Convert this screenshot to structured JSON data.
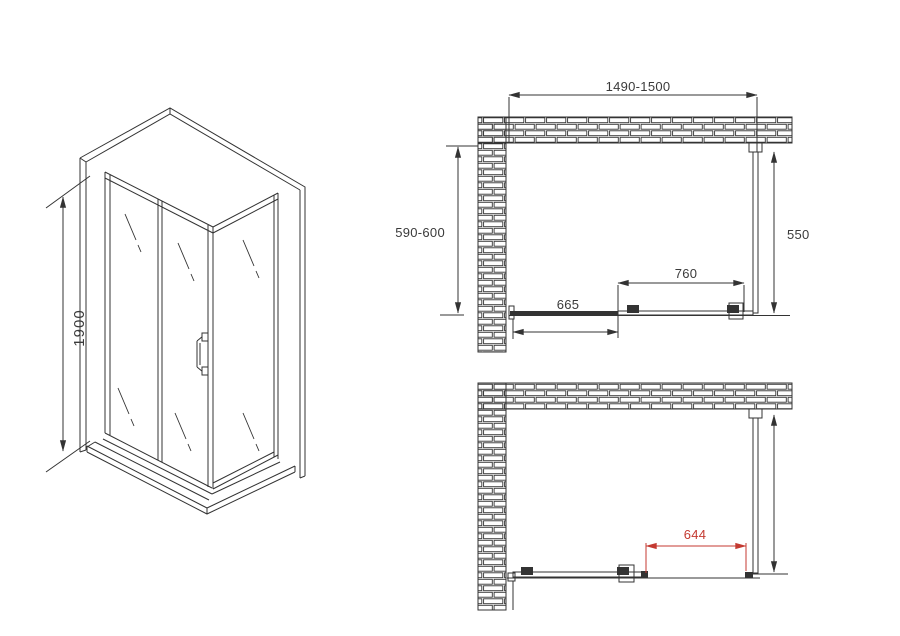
{
  "title": "Shower enclosure installation drawing",
  "colors": {
    "line": "#333333",
    "red": "#c43a31",
    "text": "#3a3a3a",
    "background": "#ffffff"
  },
  "isometric": {
    "height_label": "1900"
  },
  "plan_closed": {
    "overall_width_label": "1490-1500",
    "left_depth_label": "590-600",
    "side_panel_label": "550",
    "door_width_label": "760",
    "fixed_panel_label": "665"
  },
  "plan_open": {
    "opening_label": "644"
  }
}
